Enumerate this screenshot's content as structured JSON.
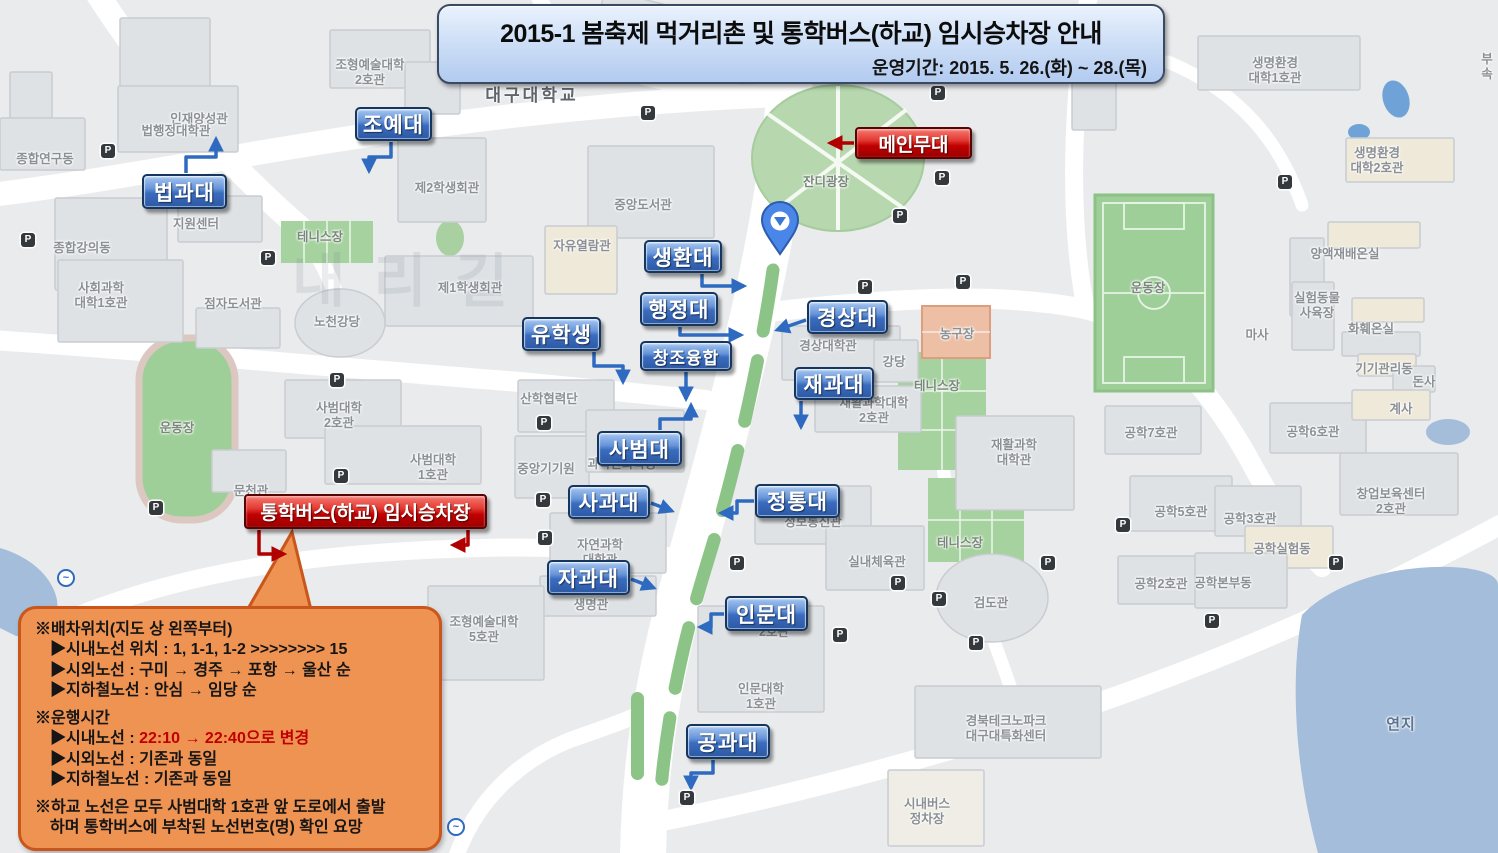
{
  "banner": {
    "title": "2015-1 봄축제 먹거리촌 및 통학버스(하교) 임시승차장 안내",
    "subtitle": "운영기간: 2015. 5. 26.(화) ~ 28.(목)"
  },
  "colors": {
    "marker_blue": "#2d59a4",
    "marker_red": "#c00000",
    "bubble_orange": "#ef9352",
    "bubble_border": "#c9571c",
    "field_green": "#9fcf98",
    "pond_blue": "#a3bdda",
    "road_white": "#ffffff",
    "arrow_blue": "#2e6bc0",
    "arrow_red": "#b00000"
  },
  "markers": {
    "blue": [
      {
        "id": "joyedae",
        "label": "조예대",
        "x": 355,
        "y": 107,
        "w": 77,
        "h": 34
      },
      {
        "id": "beopgwadae",
        "label": "법과대",
        "x": 142,
        "y": 174,
        "w": 85,
        "h": 35
      },
      {
        "id": "saenghwandae",
        "label": "생환대",
        "x": 644,
        "y": 240,
        "w": 78,
        "h": 33
      },
      {
        "id": "haengjeongdae",
        "label": "행정대",
        "x": 640,
        "y": 292,
        "w": 78,
        "h": 34
      },
      {
        "id": "yuhaksaeng",
        "label": "유학생",
        "x": 522,
        "y": 317,
        "w": 79,
        "h": 34
      },
      {
        "id": "changjoyunghap",
        "label": "창조융합",
        "x": 640,
        "y": 341,
        "w": 92,
        "h": 30,
        "cls": "small"
      },
      {
        "id": "gyeongsangdae",
        "label": "경상대",
        "x": 807,
        "y": 300,
        "w": 81,
        "h": 34
      },
      {
        "id": "jaegwadae",
        "label": "재과대",
        "x": 794,
        "y": 367,
        "w": 80,
        "h": 33
      },
      {
        "id": "sabeomdae",
        "label": "사범대",
        "x": 597,
        "y": 431,
        "w": 85,
        "h": 35
      },
      {
        "id": "sagwadae",
        "label": "사과대",
        "x": 568,
        "y": 485,
        "w": 82,
        "h": 34
      },
      {
        "id": "jeongtongdae",
        "label": "정통대",
        "x": 755,
        "y": 484,
        "w": 85,
        "h": 34
      },
      {
        "id": "jagwadae",
        "label": "자과대",
        "x": 547,
        "y": 560,
        "w": 83,
        "h": 35
      },
      {
        "id": "inmundae",
        "label": "인문대",
        "x": 725,
        "y": 596,
        "w": 83,
        "h": 35
      },
      {
        "id": "gonggwadae",
        "label": "공과대",
        "x": 686,
        "y": 724,
        "w": 84,
        "h": 35
      }
    ],
    "red": [
      {
        "id": "main-stage",
        "label": "메인무대",
        "x": 855,
        "y": 127,
        "w": 117,
        "h": 32
      },
      {
        "id": "bus-stop",
        "label": "통학버스(하교) 임시승차장",
        "x": 244,
        "y": 494,
        "w": 243,
        "h": 35
      }
    ]
  },
  "map": {
    "watermark": "내리길",
    "parking_glyph": "P",
    "metro_glyph": "~",
    "building_labels": [
      {
        "text": "인재양성관",
        "x": 199,
        "y": 112
      },
      {
        "text": "신애학사\n3호관",
        "x": 673,
        "y": 22
      },
      {
        "text": "종합연구동",
        "x": 45,
        "y": 152
      },
      {
        "text": "법행정대학관",
        "x": 176,
        "y": 124
      },
      {
        "text": "조형예술대학\n2호관",
        "x": 370,
        "y": 58
      },
      {
        "text": "대구대학교",
        "x": 532,
        "y": 86,
        "cls": "big"
      },
      {
        "text": "제2학생회관",
        "x": 447,
        "y": 181
      },
      {
        "text": "중앙도서관",
        "x": 643,
        "y": 198
      },
      {
        "text": "자유열람관",
        "x": 582,
        "y": 239
      },
      {
        "text": "제1학생회관",
        "x": 470,
        "y": 281
      },
      {
        "text": "노천강당",
        "x": 337,
        "y": 315
      },
      {
        "text": "지원센터",
        "x": 196,
        "y": 217
      },
      {
        "text": "테니스장",
        "x": 320,
        "y": 230,
        "cls": "onGreen"
      },
      {
        "text": "종합강의동",
        "x": 82,
        "y": 241
      },
      {
        "text": "사회과학\n대학1호관",
        "x": 101,
        "y": 281
      },
      {
        "text": "점자도서관",
        "x": 233,
        "y": 297
      },
      {
        "text": "잔디광장",
        "x": 826,
        "y": 175,
        "cls": "onGreen"
      },
      {
        "text": "산학협력단",
        "x": 549,
        "y": 392
      },
      {
        "text": "사범대학\n2호관",
        "x": 339,
        "y": 401
      },
      {
        "text": "사범대학\n1호관",
        "x": 433,
        "y": 453
      },
      {
        "text": "문천관",
        "x": 251,
        "y": 484
      },
      {
        "text": "운동장",
        "x": 177,
        "y": 421,
        "cls": "onGreen"
      },
      {
        "text": "과학관화학동",
        "x": 622,
        "y": 457
      },
      {
        "text": "중앙기기원",
        "x": 546,
        "y": 462
      },
      {
        "text": "자연과학\n대학관",
        "x": 600,
        "y": 538
      },
      {
        "text": "생명관",
        "x": 591,
        "y": 598
      },
      {
        "text": "조형예술대학\n5호관",
        "x": 484,
        "y": 615
      },
      {
        "text": "경상대학관",
        "x": 828,
        "y": 339
      },
      {
        "text": "강당",
        "x": 894,
        "y": 355
      },
      {
        "text": "재활과학대학\n2호관",
        "x": 874,
        "y": 396
      },
      {
        "text": "테니스장",
        "x": 937,
        "y": 379,
        "cls": "onGreen"
      },
      {
        "text": "농구장",
        "x": 957,
        "y": 327
      },
      {
        "text": "테니스장",
        "x": 960,
        "y": 536,
        "cls": "onGreen"
      },
      {
        "text": "재활과학\n대학관",
        "x": 1014,
        "y": 438
      },
      {
        "text": "운동장",
        "x": 1148,
        "y": 281,
        "cls": "onGreen"
      },
      {
        "text": "마사",
        "x": 1257,
        "y": 328
      },
      {
        "text": "생명환경\n대학1호관",
        "x": 1275,
        "y": 56
      },
      {
        "text": "생명환경\n대학2호관",
        "x": 1377,
        "y": 146
      },
      {
        "text": "양액재배온실",
        "x": 1345,
        "y": 247
      },
      {
        "text": "실험동물\n사육장",
        "x": 1317,
        "y": 291
      },
      {
        "text": "화훼온실",
        "x": 1371,
        "y": 322
      },
      {
        "text": "기기관리동",
        "x": 1384,
        "y": 362
      },
      {
        "text": "돈사",
        "x": 1424,
        "y": 375
      },
      {
        "text": "계사",
        "x": 1401,
        "y": 402
      },
      {
        "text": "공학7호관",
        "x": 1151,
        "y": 426
      },
      {
        "text": "공학6호관",
        "x": 1313,
        "y": 425
      },
      {
        "text": "공학5호관",
        "x": 1181,
        "y": 505
      },
      {
        "text": "공학3호관",
        "x": 1250,
        "y": 512
      },
      {
        "text": "창업보육센터\n2호관",
        "x": 1391,
        "y": 487
      },
      {
        "text": "공학실험동",
        "x": 1282,
        "y": 542
      },
      {
        "text": "공학2호관",
        "x": 1161,
        "y": 577
      },
      {
        "text": "공학본부동",
        "x": 1223,
        "y": 576
      },
      {
        "text": "검도관",
        "x": 991,
        "y": 596
      },
      {
        "text": "정보통신관",
        "x": 813,
        "y": 515
      },
      {
        "text": "실내체육관",
        "x": 877,
        "y": 555
      },
      {
        "text": "2호관",
        "x": 774,
        "y": 625
      },
      {
        "text": "인문대학\n1호관",
        "x": 761,
        "y": 682
      },
      {
        "text": "경북테크노파크\n대구대특화센터",
        "x": 1006,
        "y": 714
      },
      {
        "text": "연지",
        "x": 1401,
        "y": 716,
        "cls": "pond"
      },
      {
        "text": "시내버스\n정차장",
        "x": 927,
        "y": 797
      },
      {
        "text": "부속",
        "x": 1487,
        "y": 52
      }
    ],
    "parking_icons": [
      [
        108,
        151
      ],
      [
        28,
        240
      ],
      [
        268,
        258
      ],
      [
        156,
        508
      ],
      [
        337,
        380
      ],
      [
        341,
        476
      ],
      [
        544,
        423
      ],
      [
        543,
        500
      ],
      [
        545,
        538
      ],
      [
        648,
        113
      ],
      [
        938,
        93
      ],
      [
        942,
        178
      ],
      [
        900,
        216
      ],
      [
        963,
        282
      ],
      [
        865,
        287
      ],
      [
        737,
        563
      ],
      [
        840,
        635
      ],
      [
        898,
        583
      ],
      [
        939,
        599
      ],
      [
        1048,
        563
      ],
      [
        976,
        643
      ],
      [
        1123,
        525
      ],
      [
        1336,
        563
      ],
      [
        1212,
        621
      ],
      [
        687,
        798
      ],
      [
        1285,
        182
      ]
    ],
    "metro_icons": [
      [
        66,
        578
      ],
      [
        456,
        827
      ]
    ]
  },
  "bubble": {
    "sections": [
      {
        "title": "※배차위치(지도 상 왼쪽부터)",
        "items": [
          [
            {
              "t": "▶시내노선 위치 : 1, 1-1, 1-2 >>>>>>>> 15"
            }
          ],
          [
            {
              "t": "▶시외노선 : 구미 → 경주 → 포항 → 울산 순"
            }
          ],
          [
            {
              "t": "▶지하철노선 : 안심 → 임당 순"
            }
          ]
        ]
      },
      {
        "title": "※운행시간",
        "items": [
          [
            {
              "t": "▶시내노선 : "
            },
            {
              "t": "22:10 → 22:40으로 변경",
              "red": true
            }
          ],
          [
            {
              "t": "▶시외노선 : 기존과 동일"
            }
          ],
          [
            {
              "t": "▶지하철노선 : 기존과 동일"
            }
          ]
        ]
      },
      {
        "title": "※하교 노선은 모두 사범대학 1호관 앞 도로에서 출발",
        "items": [
          [
            {
              "t": "하며 통학버스에 부착된 노선번호(명) 확인 요망"
            }
          ]
        ]
      }
    ]
  }
}
